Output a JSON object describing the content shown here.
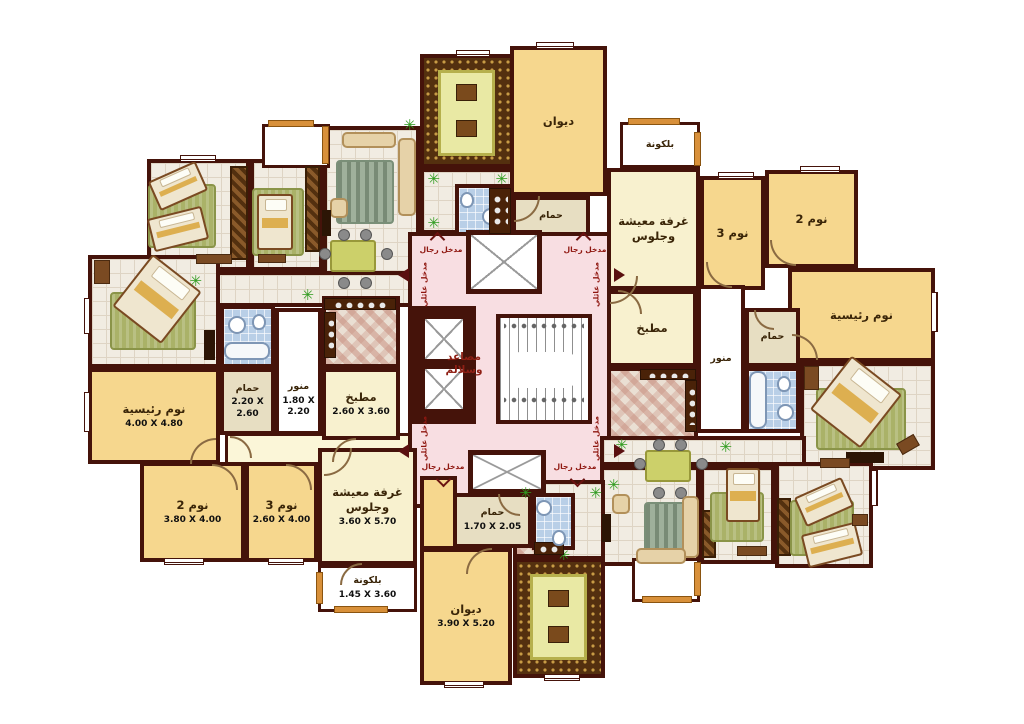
{
  "palette": {
    "wall": "#45130a",
    "y": "#f6d78e",
    "c": "#f8f1cf",
    "t": "#e7dec2",
    "w": "#ffffff",
    "p": "#f8dee2",
    "pal": "#fbf6d8"
  },
  "texts": {
    "men_entrance": "مدخل رجال",
    "family_entrance": "مدخل عائلي",
    "core_label": [
      "مصاعد",
      "وسلالم"
    ]
  },
  "room_labels": {
    "diwan": "ديوان",
    "bath": "حمام",
    "balcony": "بلكونة",
    "living": "غرفة معيشة\nوجلوس",
    "bed3": "نوم 3",
    "bed2": "نوم 2",
    "master": "نوم رئيسية",
    "kitchen": "مطبخ",
    "lightwell": "منور"
  },
  "dimensions": {
    "master_left": "4.00 X 4.80",
    "bath_left": "2.20 X 2.60",
    "lightwell_left": "1.80 X 2.20",
    "kitchen_left": "2.60 X 3.60",
    "bed2_left": "3.80 X 4.00",
    "bed3_left": "2.60 X 4.00",
    "living_left": "3.60 X 5.70",
    "balcony_left": "1.45 X 3.60",
    "diwan_bottom": "3.90 X 5.20",
    "bath_bottom": "1.70 X 2.05"
  },
  "zones": [
    [
      "twin-left-bedroom",
      147,
      159,
      103,
      112,
      null,
      "tile",
      null,
      null
    ],
    [
      "single-left-bedroom",
      250,
      159,
      73,
      112,
      null,
      "tile",
      null,
      null
    ],
    [
      "living-left-furnished",
      323,
      126,
      97,
      162,
      null,
      "tile",
      null,
      null
    ],
    [
      "hall-left",
      147,
      271,
      276,
      36,
      null,
      "tile",
      null,
      null
    ],
    [
      "master-left-furnished",
      88,
      255,
      132,
      113,
      null,
      "tile",
      null,
      null
    ],
    [
      "bath-left-furnished",
      220,
      305,
      55,
      63,
      null,
      "blue",
      null,
      null
    ],
    [
      "kitchen-left-furnished",
      322,
      296,
      78,
      72,
      null,
      "checker",
      null,
      null
    ],
    [
      "corridor-left",
      225,
      433,
      198,
      32,
      "pal",
      "thin",
      null,
      null
    ],
    [
      "balcony-top-left",
      262,
      124,
      68,
      44,
      "w",
      "thin",
      null,
      null
    ],
    [
      "entry-top",
      420,
      168,
      94,
      66,
      null,
      "tile",
      null,
      null
    ],
    [
      "majlis-top",
      420,
      54,
      94,
      114,
      null,
      "majlis",
      null,
      null
    ],
    [
      "bath-top-furnished",
      455,
      184,
      57,
      52,
      null,
      "blue",
      null,
      null
    ],
    [
      "core",
      408,
      232,
      208,
      276,
      "p",
      null,
      null,
      null
    ],
    [
      "balcony-top-right",
      620,
      122,
      80,
      46,
      "w",
      "thin small",
      "بلكونة",
      null
    ],
    [
      "living-right",
      607,
      168,
      93,
      122,
      "c",
      null,
      "غرفة معيشة\nوجلوس",
      null
    ],
    [
      "bed3-right",
      700,
      176,
      65,
      114,
      "y",
      null,
      "نوم 3",
      null
    ],
    [
      "bed2-right",
      765,
      170,
      93,
      98,
      "y",
      null,
      "نوم 2",
      null
    ],
    [
      "master-right",
      788,
      268,
      147,
      94,
      "y",
      null,
      "نوم رئيسية",
      null
    ],
    [
      "kitchen-right",
      607,
      290,
      90,
      77,
      "c",
      null,
      "مطبخ",
      null
    ],
    [
      "lightwell-right",
      697,
      285,
      48,
      148,
      "w",
      "small",
      "منور",
      null
    ],
    [
      "bath-right",
      745,
      308,
      55,
      59,
      "t",
      "small",
      "حمام",
      null
    ],
    [
      "diwan-top",
      510,
      46,
      97,
      150,
      "y",
      null,
      "ديوان",
      null
    ],
    [
      "bath-top",
      512,
      196,
      78,
      40,
      "t",
      "small",
      "حمام",
      null
    ],
    [
      "kitchen-right-furnished",
      607,
      367,
      91,
      73,
      null,
      "checker",
      null,
      null
    ],
    [
      "bath-right-furnished",
      745,
      367,
      55,
      66,
      null,
      "blue",
      null,
      null
    ],
    [
      "master-right-furnished",
      800,
      362,
      135,
      108,
      null,
      "tile",
      null,
      null
    ],
    [
      "hall-right",
      600,
      436,
      206,
      30,
      null,
      "tile",
      null,
      null
    ],
    [
      "living-right-furnished",
      600,
      466,
      100,
      100,
      null,
      "tile",
      null,
      null
    ],
    [
      "single-right-bedroom",
      700,
      466,
      75,
      98,
      null,
      "tile",
      null,
      null
    ],
    [
      "twin-right-bedroom",
      775,
      462,
      98,
      106,
      null,
      "tile",
      null,
      null
    ],
    [
      "entry-bottom",
      513,
      480,
      92,
      80,
      null,
      "tile",
      null,
      null
    ],
    [
      "kitchenette-bottom",
      513,
      500,
      50,
      58,
      null,
      "checker",
      null,
      null
    ],
    [
      "bath-bottom-furnished",
      532,
      493,
      43,
      57,
      null,
      "blue",
      null,
      null
    ],
    [
      "majlis-bottom",
      513,
      558,
      92,
      120,
      null,
      "majlis",
      null,
      null
    ],
    [
      "bath-bottom",
      453,
      493,
      79,
      55,
      "t",
      "small",
      "حمام",
      "1.70 X 2.05"
    ],
    [
      "diwan-entry",
      420,
      476,
      37,
      74,
      "y",
      null,
      null,
      null
    ],
    [
      "diwan-bottom",
      420,
      548,
      92,
      137,
      "y",
      null,
      "ديوان",
      "3.90 X 5.20"
    ],
    [
      "master-left",
      88,
      368,
      132,
      96,
      "y",
      null,
      "نوم رئيسية",
      "4.00 X 4.80"
    ],
    [
      "bath-left",
      220,
      368,
      55,
      67,
      "t",
      "small",
      "حمام",
      "2.20 X 2.60"
    ],
    [
      "lightwell-left",
      275,
      308,
      47,
      127,
      "w",
      "small lbot",
      "منور",
      "1.80 X 2.20"
    ],
    [
      "kitchen-left",
      322,
      368,
      78,
      72,
      "c",
      null,
      "مطبخ",
      "2.60 X 3.60"
    ],
    [
      "bed2-left",
      140,
      462,
      105,
      100,
      "y",
      null,
      "نوم 2",
      "3.80 X 4.00"
    ],
    [
      "bed3-left",
      245,
      462,
      73,
      100,
      "y",
      null,
      "نوم 3",
      "2.60 X 4.00"
    ],
    [
      "living-left",
      318,
      448,
      99,
      117,
      "c",
      null,
      "غرفة معيشة\nوجلوس",
      "3.60 X 5.70"
    ],
    [
      "balcony-left",
      318,
      565,
      99,
      47,
      "w",
      "thin small",
      "بلكونة",
      "1.45 X 3.60"
    ],
    [
      "balcony-bottom-right",
      632,
      558,
      68,
      44,
      "w",
      "thin",
      null,
      null
    ],
    [
      "elevator-shaft",
      412,
      306,
      64,
      118,
      null,
      "shaft nob",
      null,
      null
    ],
    [
      "elevator-1",
      420,
      314,
      48,
      50,
      null,
      "xbox",
      null,
      null
    ],
    [
      "elevator-2",
      420,
      364,
      48,
      50,
      null,
      "xbox",
      null,
      null
    ],
    [
      "stairs",
      496,
      314,
      96,
      110,
      null,
      "stairs",
      null,
      null
    ],
    [
      "stairs-dots-top",
      504,
      322,
      80,
      8,
      null,
      "dots nob",
      null,
      null
    ],
    [
      "stairs-dots-bottom",
      504,
      396,
      80,
      8,
      null,
      "dots nob",
      null,
      null
    ],
    [
      "stairs-landing",
      510,
      352,
      66,
      36,
      null,
      "landing nob",
      null,
      null
    ],
    [
      "vestibule-top",
      466,
      230,
      76,
      64,
      null,
      "xbox",
      null,
      null
    ],
    [
      "vestibule-bottom",
      468,
      450,
      78,
      44,
      null,
      "xbox",
      null,
      null
    ]
  ],
  "furniture": [
    [
      "ward",
      230,
      166,
      18,
      94,
      0
    ],
    [
      "rug",
      148,
      184,
      68,
      64,
      0
    ],
    [
      "bed",
      152,
      170,
      52,
      32,
      -24
    ],
    [
      "bed",
      150,
      212,
      56,
      34,
      -14
    ],
    [
      "side",
      196,
      254,
      36,
      10,
      0
    ],
    [
      "ward",
      305,
      166,
      15,
      86,
      0
    ],
    [
      "rug",
      252,
      188,
      52,
      68,
      0
    ],
    [
      "bed",
      257,
      194,
      36,
      56,
      0
    ],
    [
      "side",
      258,
      254,
      28,
      9,
      0
    ],
    [
      "rug2",
      336,
      160,
      58,
      64,
      0
    ],
    [
      "sofa",
      398,
      138,
      18,
      78,
      0
    ],
    [
      "sofa",
      342,
      132,
      54,
      16,
      0
    ],
    [
      "sofa",
      330,
      198,
      18,
      20,
      0
    ],
    [
      "tv",
      322,
      210,
      9,
      26,
      0
    ],
    [
      "dining",
      330,
      240,
      46,
      32,
      0
    ],
    [
      "plant",
      402,
      118,
      14,
      14,
      0
    ],
    [
      "plant",
      300,
      288,
      14,
      14,
      0
    ],
    [
      "plant",
      188,
      274,
      14,
      14,
      0
    ],
    [
      "rug",
      110,
      292,
      86,
      58,
      0
    ],
    [
      "bed",
      126,
      266,
      62,
      66,
      38
    ],
    [
      "side",
      94,
      260,
      16,
      24,
      0
    ],
    [
      "tv",
      204,
      330,
      11,
      30,
      0
    ],
    [
      "sink",
      228,
      316,
      18,
      18,
      0
    ],
    [
      "wc",
      252,
      314,
      14,
      16,
      0
    ],
    [
      "tub",
      224,
      342,
      46,
      18,
      0
    ],
    [
      "counter",
      324,
      298,
      72,
      12,
      0
    ],
    [
      "counter",
      324,
      312,
      12,
      46,
      0
    ],
    [
      "plant",
      426,
      172,
      14,
      14,
      0
    ],
    [
      "plant",
      494,
      172,
      14,
      14,
      0
    ],
    [
      "plant",
      426,
      216,
      14,
      14,
      0
    ],
    [
      "mat",
      438,
      70,
      57,
      86,
      0
    ],
    [
      "msq",
      456,
      84,
      21,
      17,
      0
    ],
    [
      "msq",
      456,
      120,
      21,
      17,
      0
    ],
    [
      "wc",
      460,
      192,
      14,
      16,
      0
    ],
    [
      "sink",
      482,
      208,
      17,
      17,
      0
    ],
    [
      "counter",
      489,
      188,
      22,
      46,
      0
    ],
    [
      "counter",
      640,
      369,
      56,
      11,
      0
    ],
    [
      "counter",
      685,
      380,
      12,
      52,
      0
    ],
    [
      "tub",
      749,
      371,
      18,
      58,
      0
    ],
    [
      "wc",
      777,
      376,
      14,
      16,
      0
    ],
    [
      "sink",
      777,
      404,
      17,
      17,
      0
    ],
    [
      "rug",
      816,
      388,
      90,
      62,
      0
    ],
    [
      "bed",
      824,
      368,
      64,
      68,
      38
    ],
    [
      "side",
      804,
      366,
      15,
      24,
      0
    ],
    [
      "tv",
      846,
      452,
      38,
      11,
      0
    ],
    [
      "side",
      898,
      438,
      20,
      13,
      -30
    ],
    [
      "dining",
      645,
      450,
      46,
      32,
      0
    ],
    [
      "rug2",
      644,
      502,
      50,
      54,
      0
    ],
    [
      "sofa",
      682,
      496,
      17,
      62,
      0
    ],
    [
      "sofa",
      636,
      548,
      50,
      16,
      0
    ],
    [
      "sofa",
      612,
      494,
      18,
      20,
      0
    ],
    [
      "tv",
      602,
      514,
      9,
      28,
      0
    ],
    [
      "plant",
      606,
      478,
      14,
      14,
      0
    ],
    [
      "plant",
      614,
      438,
      14,
      14,
      0
    ],
    [
      "plant",
      718,
      440,
      14,
      14,
      0
    ],
    [
      "ward",
      702,
      510,
      14,
      48,
      0
    ],
    [
      "rug",
      710,
      492,
      54,
      50,
      0
    ],
    [
      "bed",
      726,
      468,
      34,
      54,
      0
    ],
    [
      "side",
      737,
      546,
      30,
      10,
      0
    ],
    [
      "ward",
      777,
      498,
      14,
      58,
      0
    ],
    [
      "rug",
      790,
      500,
      64,
      56,
      0
    ],
    [
      "bed",
      798,
      486,
      52,
      32,
      -24
    ],
    [
      "bed",
      804,
      528,
      56,
      34,
      -14
    ],
    [
      "side",
      852,
      514,
      16,
      12,
      0
    ],
    [
      "side",
      820,
      458,
      30,
      10,
      0
    ],
    [
      "plant",
      518,
      486,
      14,
      14,
      0
    ],
    [
      "plant",
      588,
      486,
      14,
      14,
      0
    ],
    [
      "plant",
      556,
      548,
      14,
      14,
      0
    ],
    [
      "counter",
      534,
      542,
      30,
      13,
      0
    ],
    [
      "sink",
      536,
      500,
      16,
      16,
      0
    ],
    [
      "wc",
      552,
      530,
      14,
      16,
      0
    ],
    [
      "mat",
      530,
      574,
      57,
      86,
      0
    ],
    [
      "msq",
      548,
      590,
      21,
      17,
      0
    ],
    [
      "msq",
      548,
      626,
      21,
      17,
      0
    ],
    [
      "rail",
      628,
      118,
      52,
      7,
      0
    ],
    [
      "rail",
      694,
      132,
      7,
      34,
      0
    ],
    [
      "rail",
      268,
      120,
      46,
      7,
      0
    ],
    [
      "rail",
      322,
      126,
      7,
      38,
      0
    ],
    [
      "rail",
      334,
      606,
      54,
      7,
      0
    ],
    [
      "rail",
      316,
      572,
      7,
      32,
      0
    ],
    [
      "rail",
      642,
      596,
      50,
      7,
      0
    ],
    [
      "rail",
      694,
      562,
      7,
      34,
      0
    ],
    [
      "window",
      536,
      42,
      38,
      7,
      0
    ],
    [
      "window",
      456,
      50,
      34,
      7,
      0
    ],
    [
      "window",
      180,
      155,
      36,
      7,
      0
    ],
    [
      "window",
      84,
      298,
      7,
      36,
      0
    ],
    [
      "window",
      84,
      392,
      7,
      40,
      0
    ],
    [
      "window",
      164,
      558,
      40,
      7,
      0
    ],
    [
      "window",
      268,
      558,
      36,
      7,
      0
    ],
    [
      "window",
      931,
      292,
      7,
      40,
      0
    ],
    [
      "window",
      800,
      166,
      40,
      7,
      0
    ],
    [
      "window",
      718,
      172,
      36,
      7,
      0
    ],
    [
      "window",
      444,
      681,
      40,
      7,
      0
    ],
    [
      "window",
      544,
      674,
      36,
      7,
      0
    ],
    [
      "window",
      871,
      470,
      7,
      36,
      0
    ],
    [
      "chev-up",
      432,
      234,
      11,
      11,
      0
    ],
    [
      "chev-up",
      578,
      234,
      11,
      11,
      0
    ],
    [
      "chev-down",
      438,
      474,
      11,
      11,
      0
    ],
    [
      "chev-down",
      572,
      474,
      11,
      11,
      0
    ],
    [
      "tri-l",
      398,
      268,
      0,
      0,
      0
    ],
    [
      "tri-l",
      398,
      444,
      0,
      0,
      0
    ],
    [
      "tri-r",
      614,
      268,
      0,
      0,
      0
    ],
    [
      "tri-r",
      614,
      444,
      0,
      0,
      0
    ]
  ],
  "doors": [
    [
      190,
      438,
      26,
      "tl"
    ],
    [
      230,
      436,
      22,
      "tr"
    ],
    [
      332,
      438,
      24,
      "tl"
    ],
    [
      212,
      464,
      26,
      "tr"
    ],
    [
      286,
      464,
      26,
      "tr"
    ],
    [
      324,
      448,
      28,
      "br"
    ],
    [
      340,
      563,
      22,
      "tl"
    ],
    [
      466,
      548,
      26,
      "tl"
    ],
    [
      498,
      494,
      22,
      "bl"
    ],
    [
      514,
      196,
      26,
      "br"
    ],
    [
      610,
      276,
      28,
      "br"
    ],
    [
      618,
      290,
      24,
      "tr"
    ],
    [
      706,
      262,
      26,
      "bl"
    ],
    [
      770,
      240,
      26,
      "bl"
    ],
    [
      792,
      334,
      26,
      "tr"
    ],
    [
      754,
      310,
      20,
      "bl"
    ]
  ],
  "free_labels": [
    {
      "k": "core_label",
      "x": 434,
      "y": 351,
      "w": 60,
      "cls": "core"
    },
    {
      "k": "men_entrance",
      "x": 412,
      "y": 245,
      "w": 58,
      "cls": ""
    },
    {
      "k": "men_entrance",
      "x": 556,
      "y": 245,
      "w": 58,
      "cls": ""
    },
    {
      "k": "men_entrance",
      "x": 414,
      "y": 462,
      "w": 58,
      "cls": ""
    },
    {
      "k": "men_entrance",
      "x": 546,
      "y": 462,
      "w": 58,
      "cls": ""
    },
    {
      "k": "family_entrance",
      "x": 398,
      "y": 280,
      "w": 52,
      "cls": "vert"
    },
    {
      "k": "family_entrance",
      "x": 570,
      "y": 280,
      "w": 52,
      "cls": "vert"
    },
    {
      "k": "family_entrance",
      "x": 398,
      "y": 434,
      "w": 52,
      "cls": "vert"
    },
    {
      "k": "family_entrance",
      "x": 570,
      "y": 434,
      "w": 52,
      "cls": "vert"
    }
  ]
}
